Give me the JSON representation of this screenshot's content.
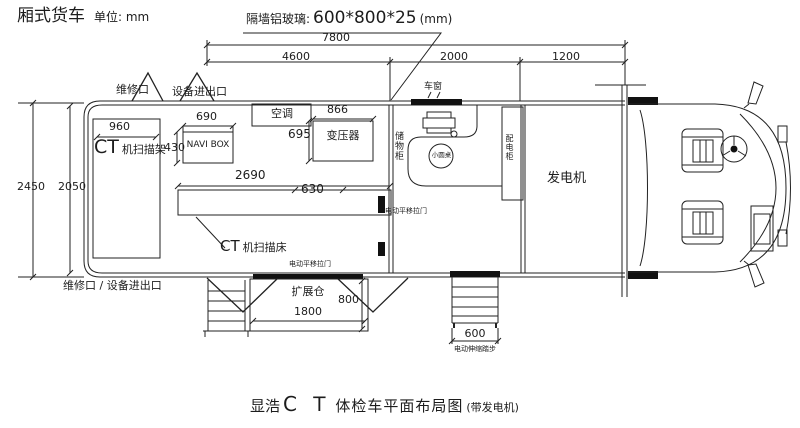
{
  "header": {
    "vehicle_type": "厢式货车",
    "unit_note": "单位: mm",
    "partition_note_label": "隔墙铝玻璃:",
    "partition_note_value": "600*800*25",
    "partition_note_unit": "(mm)"
  },
  "dims": {
    "total_length": "7800",
    "cabin_length": "4600",
    "mid_length": "2000",
    "gen_length": "1200",
    "overall_width": "2450",
    "inner_width": "2050",
    "gantry_width": "960",
    "navi_width": "690",
    "navi_depth": "430",
    "bed_length": "2690",
    "bed_width": "630",
    "transformer_width": "866",
    "transformer_depth": "695",
    "expansion_length": "1800",
    "expansion_depth": "800",
    "steps_width": "600"
  },
  "labels": {
    "hatch_maintenance": "维修口",
    "hatch_equipment": "设备进出口",
    "bottom_ports": "维修口 /  设备进出口",
    "ct_prefix": "CT",
    "gantry": "机扫描架",
    "bed": "机扫描床",
    "navi_box": "NAVI BOX",
    "air_conditioner": "空调",
    "transformer": "变压器",
    "window": "车窗",
    "storage_cabinet": "储物柜",
    "round_table": "小圆桌",
    "power_cabinet": "配电柜",
    "generator": "发电机",
    "sliding_door": "电动平移拉门",
    "expansion_door": "电动平移拉门",
    "expansion": "扩展仓",
    "steps": "电动伸缩踏步"
  },
  "title": {
    "brand": "显浩",
    "ct": "C Ｔ",
    "main": "体检车平面布局图",
    "suffix": "(带发电机)"
  }
}
